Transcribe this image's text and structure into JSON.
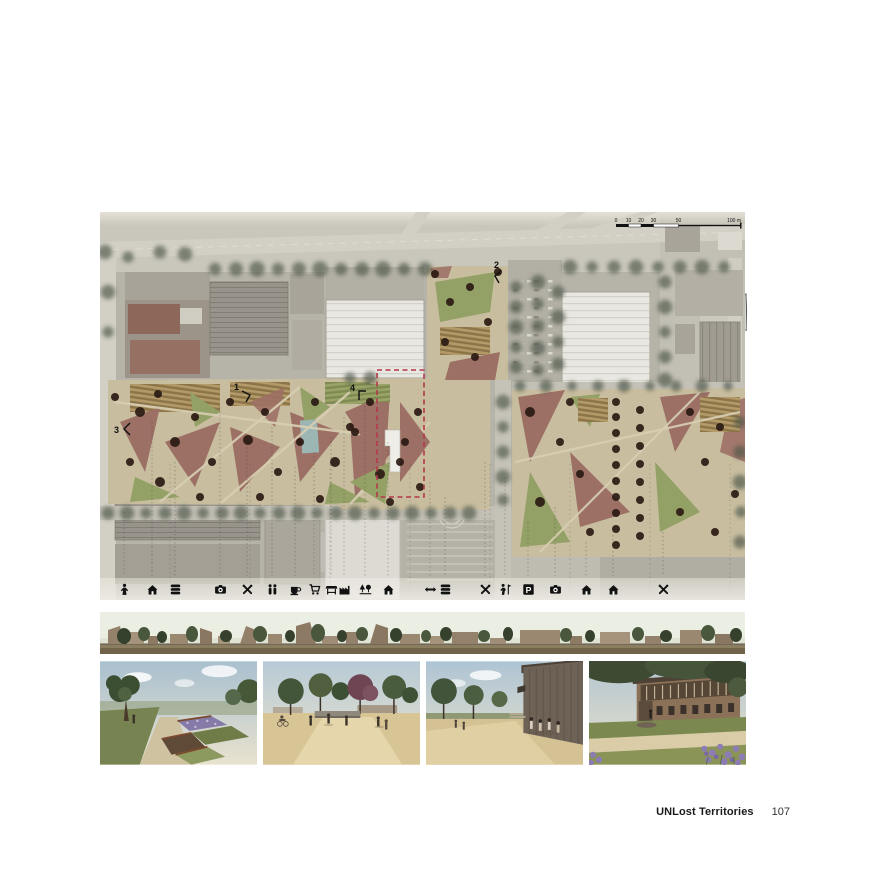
{
  "palette": {
    "page_bg": "#ffffff",
    "photo_base": "#b6b3a9",
    "photo_light": "#c9c6bc",
    "road": "#d2cfc5",
    "warehouse_roof": "#e9e7e1",
    "park_path": "#c8bd9f",
    "plaza": "#9c7065",
    "lawn": "#94a166",
    "crops_light": "#b39a68",
    "crops_dark": "#8a7448",
    "tree_dark": "#2a1a12",
    "tree_existing": "#4e5748",
    "water": "#9cb6b4",
    "accent_red": "#b5374a",
    "ink": "#111111"
  },
  "site_plan": {
    "scale_bar": {
      "ticks": [
        "0",
        "10",
        "20",
        "30",
        "50"
      ],
      "end_label": "100 m"
    },
    "markers": [
      "1",
      "2",
      "3",
      "4"
    ],
    "legend": [
      {
        "name": "sculpture-icon",
        "x": 24
      },
      {
        "name": "house-icon",
        "x": 52
      },
      {
        "name": "layers-icon",
        "x": 75
      },
      {
        "name": "camera-icon",
        "x": 120
      },
      {
        "name": "tools-icon",
        "x": 147
      },
      {
        "name": "people-icon",
        "x": 172
      },
      {
        "name": "cafe-icon",
        "x": 195
      },
      {
        "name": "cart-icon",
        "x": 214
      },
      {
        "name": "market-icon",
        "x": 231
      },
      {
        "name": "industry-icon",
        "x": 244
      },
      {
        "name": "trees-icon",
        "x": 265
      },
      {
        "name": "house-icon",
        "x": 288
      },
      {
        "name": "exchange-icon",
        "x": 330
      },
      {
        "name": "layers-icon",
        "x": 345
      },
      {
        "name": "tools-icon",
        "x": 385
      },
      {
        "name": "activity-icon",
        "x": 405
      },
      {
        "name": "parking-icon",
        "x": 428,
        "glyph": "P"
      },
      {
        "name": "camera-icon",
        "x": 455
      },
      {
        "name": "house-icon",
        "x": 486
      },
      {
        "name": "house-icon",
        "x": 513
      },
      {
        "name": "tools-icon",
        "x": 563
      }
    ]
  },
  "footer": {
    "title": "UNLost Territories",
    "page_number": "107"
  }
}
